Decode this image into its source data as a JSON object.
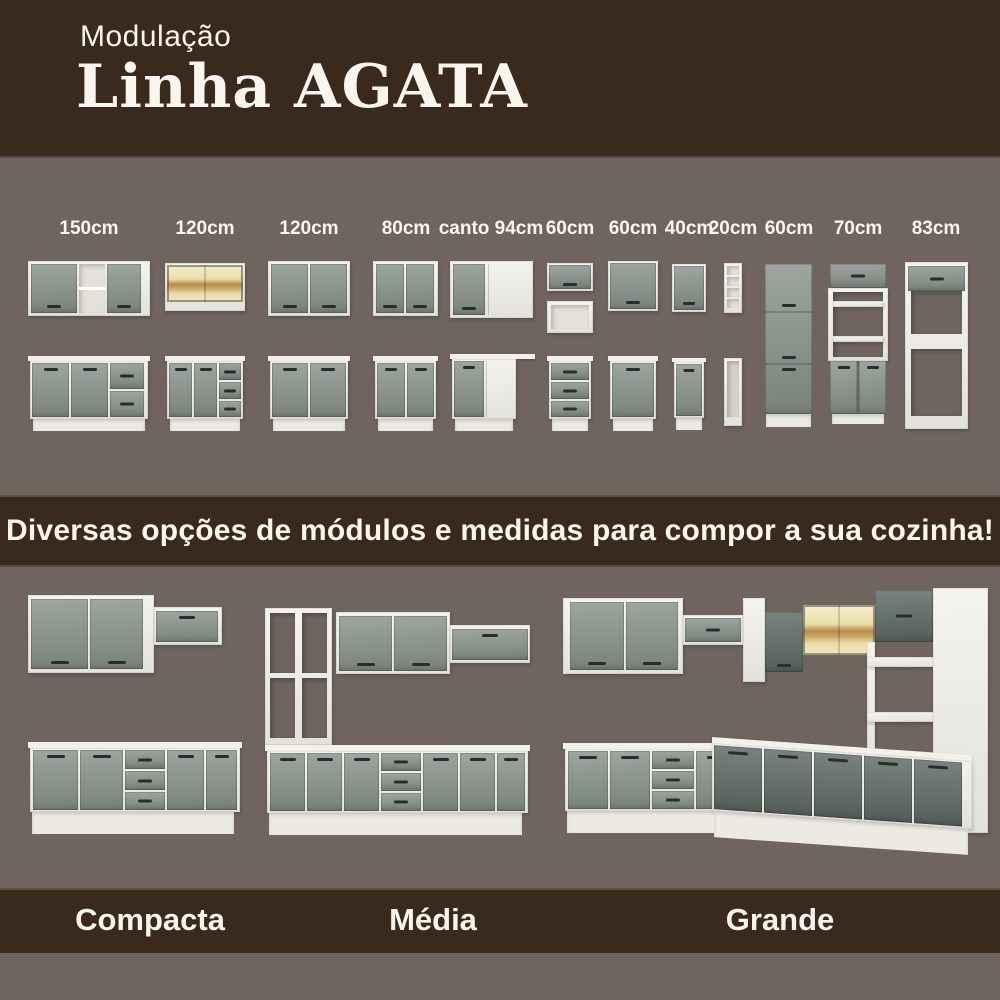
{
  "header": {
    "kicker": "Modulação",
    "title": "Linha AGATA"
  },
  "modulation": {
    "labels": [
      "150cm",
      "120cm",
      "120cm",
      "80cm",
      "canto 94cm",
      "60cm",
      "60cm",
      "40cm",
      "20cm",
      "60cm",
      "70cm",
      "83cm"
    ]
  },
  "banner": {
    "text": "Diversas opções de módulos e medidas para compor a sua cozinha!"
  },
  "kitchens": {
    "items": [
      {
        "label": "Compacta"
      },
      {
        "label": "Média"
      },
      {
        "label": "Grande"
      }
    ]
  },
  "colors": {
    "bg": "#6f645e",
    "band": "#3a2a1d",
    "text": "#f8f5ef",
    "door": "#8a948c",
    "doordark": "#5f6b66",
    "carcass": "#efede7",
    "counter": "#f3f1ea",
    "glasswood": "#b98a4e",
    "handle": "#272f2a"
  }
}
